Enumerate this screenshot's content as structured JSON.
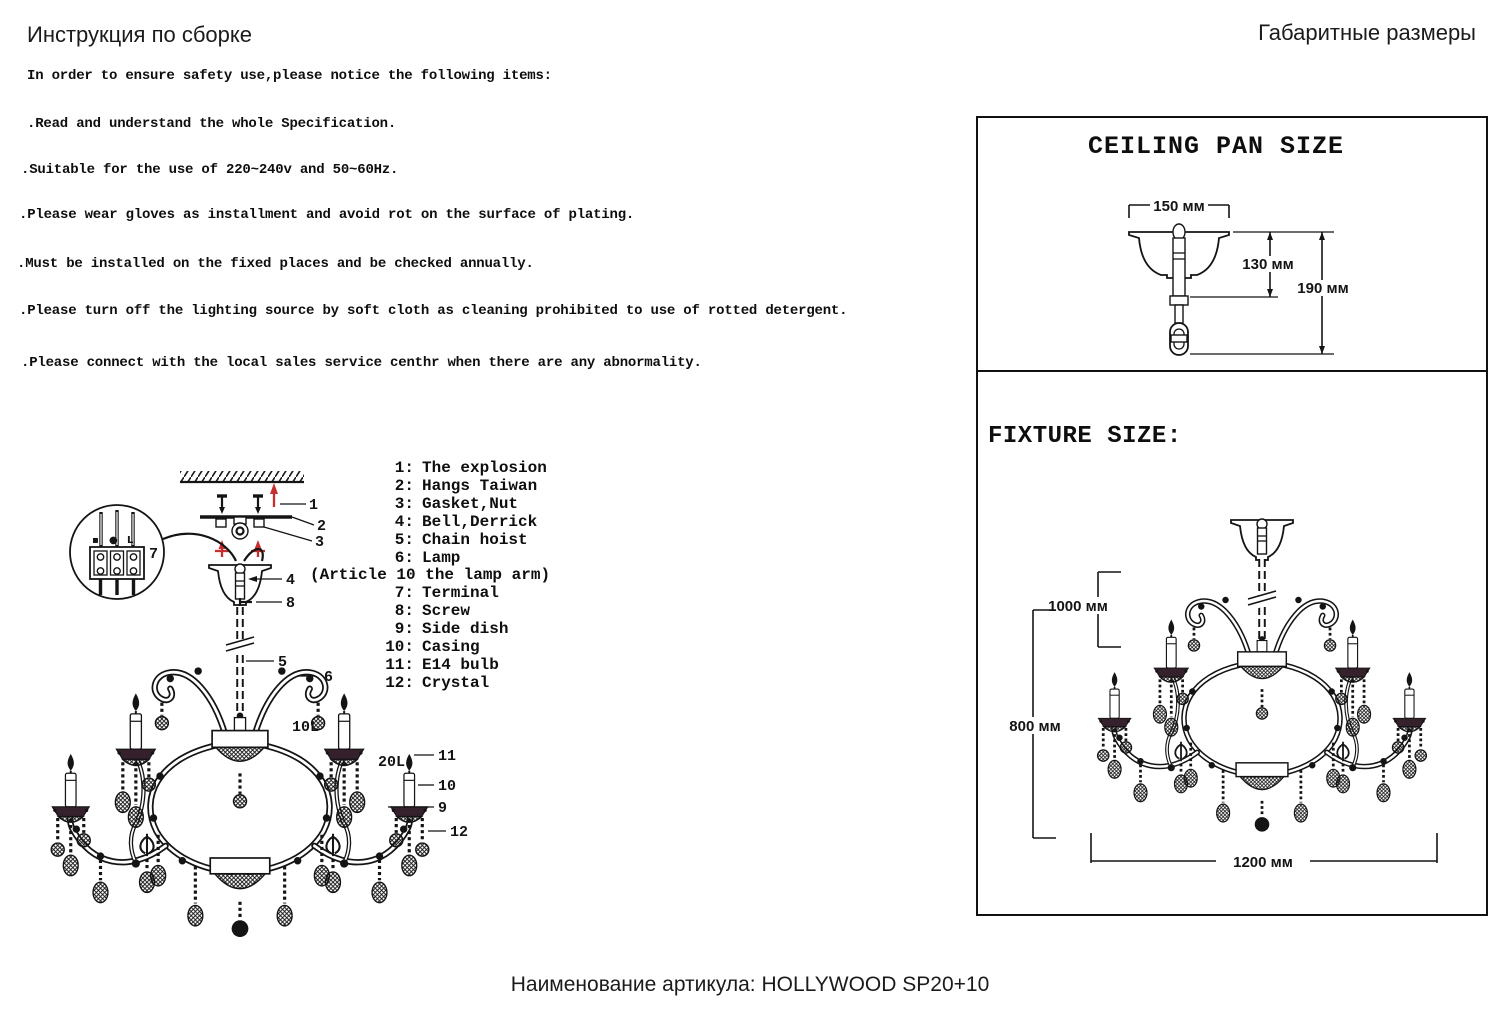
{
  "header": {
    "assembly_title": "Инструкция по сборке",
    "dimensions_title": "Габаритные размеры"
  },
  "safety": {
    "intro": "In order to ensure safety use,please notice the following items:",
    "items": [
      ".Read and understand the whole Specification.",
      ".Suitable for the use of 220~240v and 50~60Hz.",
      ".Please wear gloves as installment and avoid rot on the surface of plating.",
      ".Must be installed on the fixed places and be checked annually.",
      ".Please turn off the lighting source by soft cloth as cleaning prohibited to use of rotted detergent.",
      ".Please connect with the local sales service centhr when there are any abnormality."
    ]
  },
  "parts_list": {
    "rows": [
      {
        "num": "1:",
        "label": "The explosion"
      },
      {
        "num": "2:",
        "label": "Hangs Taiwan"
      },
      {
        "num": "3:",
        "label": "Gasket,Nut"
      },
      {
        "num": "4:",
        "label": "Bell,Derrick"
      },
      {
        "num": "5:",
        "label": "Chain hoist"
      },
      {
        "num": "6:",
        "label": "Lamp"
      },
      {
        "num": "7:",
        "label": "Terminal"
      },
      {
        "num": "8:",
        "label": "Screw"
      },
      {
        "num": "9:",
        "label": "Side dish"
      },
      {
        "num": "10:",
        "label": "Casing"
      },
      {
        "num": "11:",
        "label": "E14 bulb"
      },
      {
        "num": "12:",
        "label": "Crystal"
      }
    ],
    "note": "(Article 10 the lamp arm)"
  },
  "assembly_diagram": {
    "callouts": {
      "c1": "1",
      "c2": "2",
      "c3": "3",
      "c4": "4",
      "c5": "5",
      "c6": "6",
      "c7": "7",
      "c8": "8",
      "c9": "9",
      "c10": "10",
      "c11": "11",
      "c12": "12"
    },
    "tier_labels": {
      "inner": "10L",
      "outer": "20L"
    },
    "terminal_markings": {
      "neutral": "▪",
      "earth": "●",
      "live": "L"
    }
  },
  "dimensions_panel": {
    "ceiling_pan": {
      "title": "CEILING PAN SIZE",
      "width": "150 мм",
      "height_body": "130 мм",
      "height_total": "190 мм"
    },
    "fixture": {
      "title": "FIXTURE SIZE:",
      "suspension_height": "1000 мм",
      "body_height": "800 мм",
      "width": "1200 мм"
    }
  },
  "footer": {
    "article_name": "Наименование артикула: HOLLYWOOD SP20+10"
  },
  "colors": {
    "ink": "#141414",
    "accent_red": "#c62f2f"
  }
}
